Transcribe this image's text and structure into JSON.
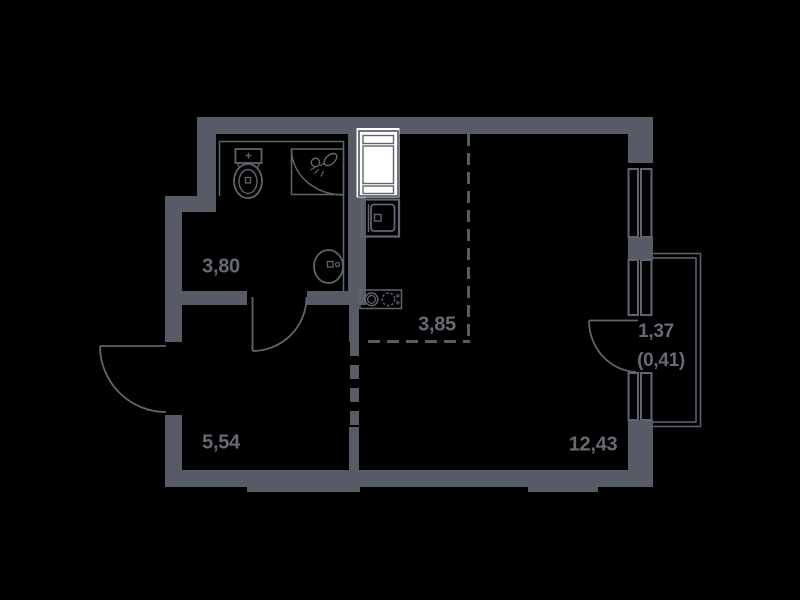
{
  "page": {
    "kind": "apartment-floor-plan",
    "background": "#000000"
  },
  "colors": {
    "wall": "#575B66",
    "line": "#60646F",
    "text": "#666A75",
    "fixture_fill": "#FFFFFF",
    "background": "#000000"
  },
  "rooms": [
    {
      "name": "bathroom",
      "area_label": "3,80"
    },
    {
      "name": "kitchen-zone",
      "area_label": "3,85"
    },
    {
      "name": "hallway",
      "area_label": "5,54"
    },
    {
      "name": "living-room",
      "area_label": "12,43"
    },
    {
      "name": "balcony",
      "area_label": "1,37",
      "area_label_coefficient": "(0,41)"
    }
  ],
  "icons": [
    {
      "name": "toilet-icon"
    },
    {
      "name": "shower-icon"
    },
    {
      "name": "washbasin-icon"
    },
    {
      "name": "refrigerator-icon"
    },
    {
      "name": "kitchen-sink-icon"
    },
    {
      "name": "stove-icon"
    },
    {
      "name": "window-icon"
    },
    {
      "name": "door-swing-icon"
    }
  ]
}
